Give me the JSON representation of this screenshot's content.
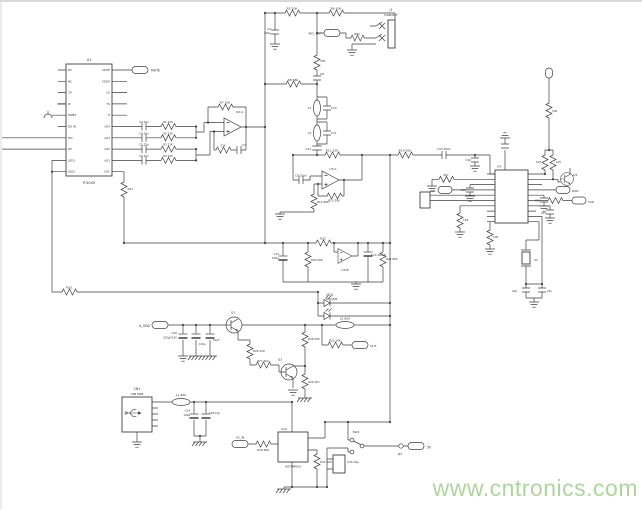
{
  "colors": {
    "wire": "#3f3f3f",
    "text": "#2f2f2f",
    "watermark": "#aed69c"
  },
  "watermark": "www.cntronics.com",
  "u1": {
    "ref": "U1",
    "part": "P-5049",
    "mute_flag": "MUTE",
    "left_pins": [
      "PD",
      "NC",
      "CP",
      "IP",
      "HWBT",
      "DG IN",
      "DM",
      "DP",
      "LED1",
      "LED2"
    ],
    "right_pins": [
      "MUTE",
      "VDDO",
      "LD",
      "TS",
      "TI",
      "AO4",
      "AO3",
      "AO2",
      "AO1",
      "OSC"
    ]
  },
  "top": {
    "c2": "C2",
    "c2_val": "100μ",
    "r5": "R5 10K",
    "r6": "R6 10K",
    "r9": "330",
    "c8": "C8",
    "r8": "R8 680",
    "mic_out": "MIC_OUT",
    "r_mic": "680",
    "j1": "J1",
    "j1_part": "HANDSET"
  },
  "dac": [
    {
      "cap": "C3 22n",
      "res": "R1 22K"
    },
    {
      "cap": "C4 22n",
      "res": "R2 22K"
    },
    {
      "cap": "C5 22n",
      "res": "R3 22K"
    },
    {
      "cap": "C6 22n",
      "res": "R4 22K"
    }
  ],
  "u2": {
    "ref": "U2:A",
    "r7": "R7 10K",
    "r15": "22K",
    "c7": "C7"
  },
  "filter": {
    "l3": "L3",
    "c10": "C10",
    "l4": "L4",
    "c11": "C11",
    "c14": "C14"
  },
  "u3a": {
    "ref": "U3:A",
    "c9": "C9 100n",
    "r11": "R11 10K",
    "r12": "R12 68K",
    "r13": "R13 20K",
    "r14": "R14 10K",
    "c15": "C15 100n"
  },
  "u3b": {
    "ref": "U3:B",
    "r22": "R22",
    "c12": "C12",
    "c12_val": "100μ",
    "r20": "R20 20K",
    "c13": "C13 100μF",
    "r24": "R24 8K2"
  },
  "led": {
    "ref": "LED1",
    "type": "LED R/B",
    "l2": "L2 600",
    "r33": "R33",
    "r21": "R21"
  },
  "power": {
    "a_vdd": "A_VDD",
    "c25": "C25",
    "c25_val": "220μF/16V",
    "c26_val": "100μ",
    "c27_val": "10μF",
    "q1": "Q1",
    "r26": "R26 220",
    "r27": "R27 2K2",
    "q2": "Q2",
    "r28": "R28 560",
    "r29": "R29 4K7",
    "r25": "R25 10K",
    "out_flag": "OUT"
  },
  "usb": {
    "cn1": "CN1",
    "part": "USB MINI",
    "l1": "L1 600",
    "c24": "C24",
    "c24_val": "100μ",
    "c28": "C28 10μ"
  },
  "reg": {
    "in_flag": "5V_IN",
    "r30": "R30 480",
    "ref": "U12",
    "part": "LM78M05A",
    "r31": "R31 560",
    "c30": "C30 10μ",
    "sw": "SW1",
    "jp": "JP1",
    "out_flag": "5V"
  },
  "u4": {
    "ref": "U4",
    "c16": "C16",
    "r16": "4K7",
    "c18": "C18",
    "vol": "VOL",
    "r_l7": "1K0",
    "r_l10": "10K",
    "r17": "1K5",
    "r18": "1K5",
    "r15": "10K",
    "q3": "Q3",
    "rxd": "RXD",
    "c19": "C19",
    "txd": "TXD",
    "c20": "C20",
    "x1": "X1",
    "c21": "22p",
    "c22": "22p"
  }
}
